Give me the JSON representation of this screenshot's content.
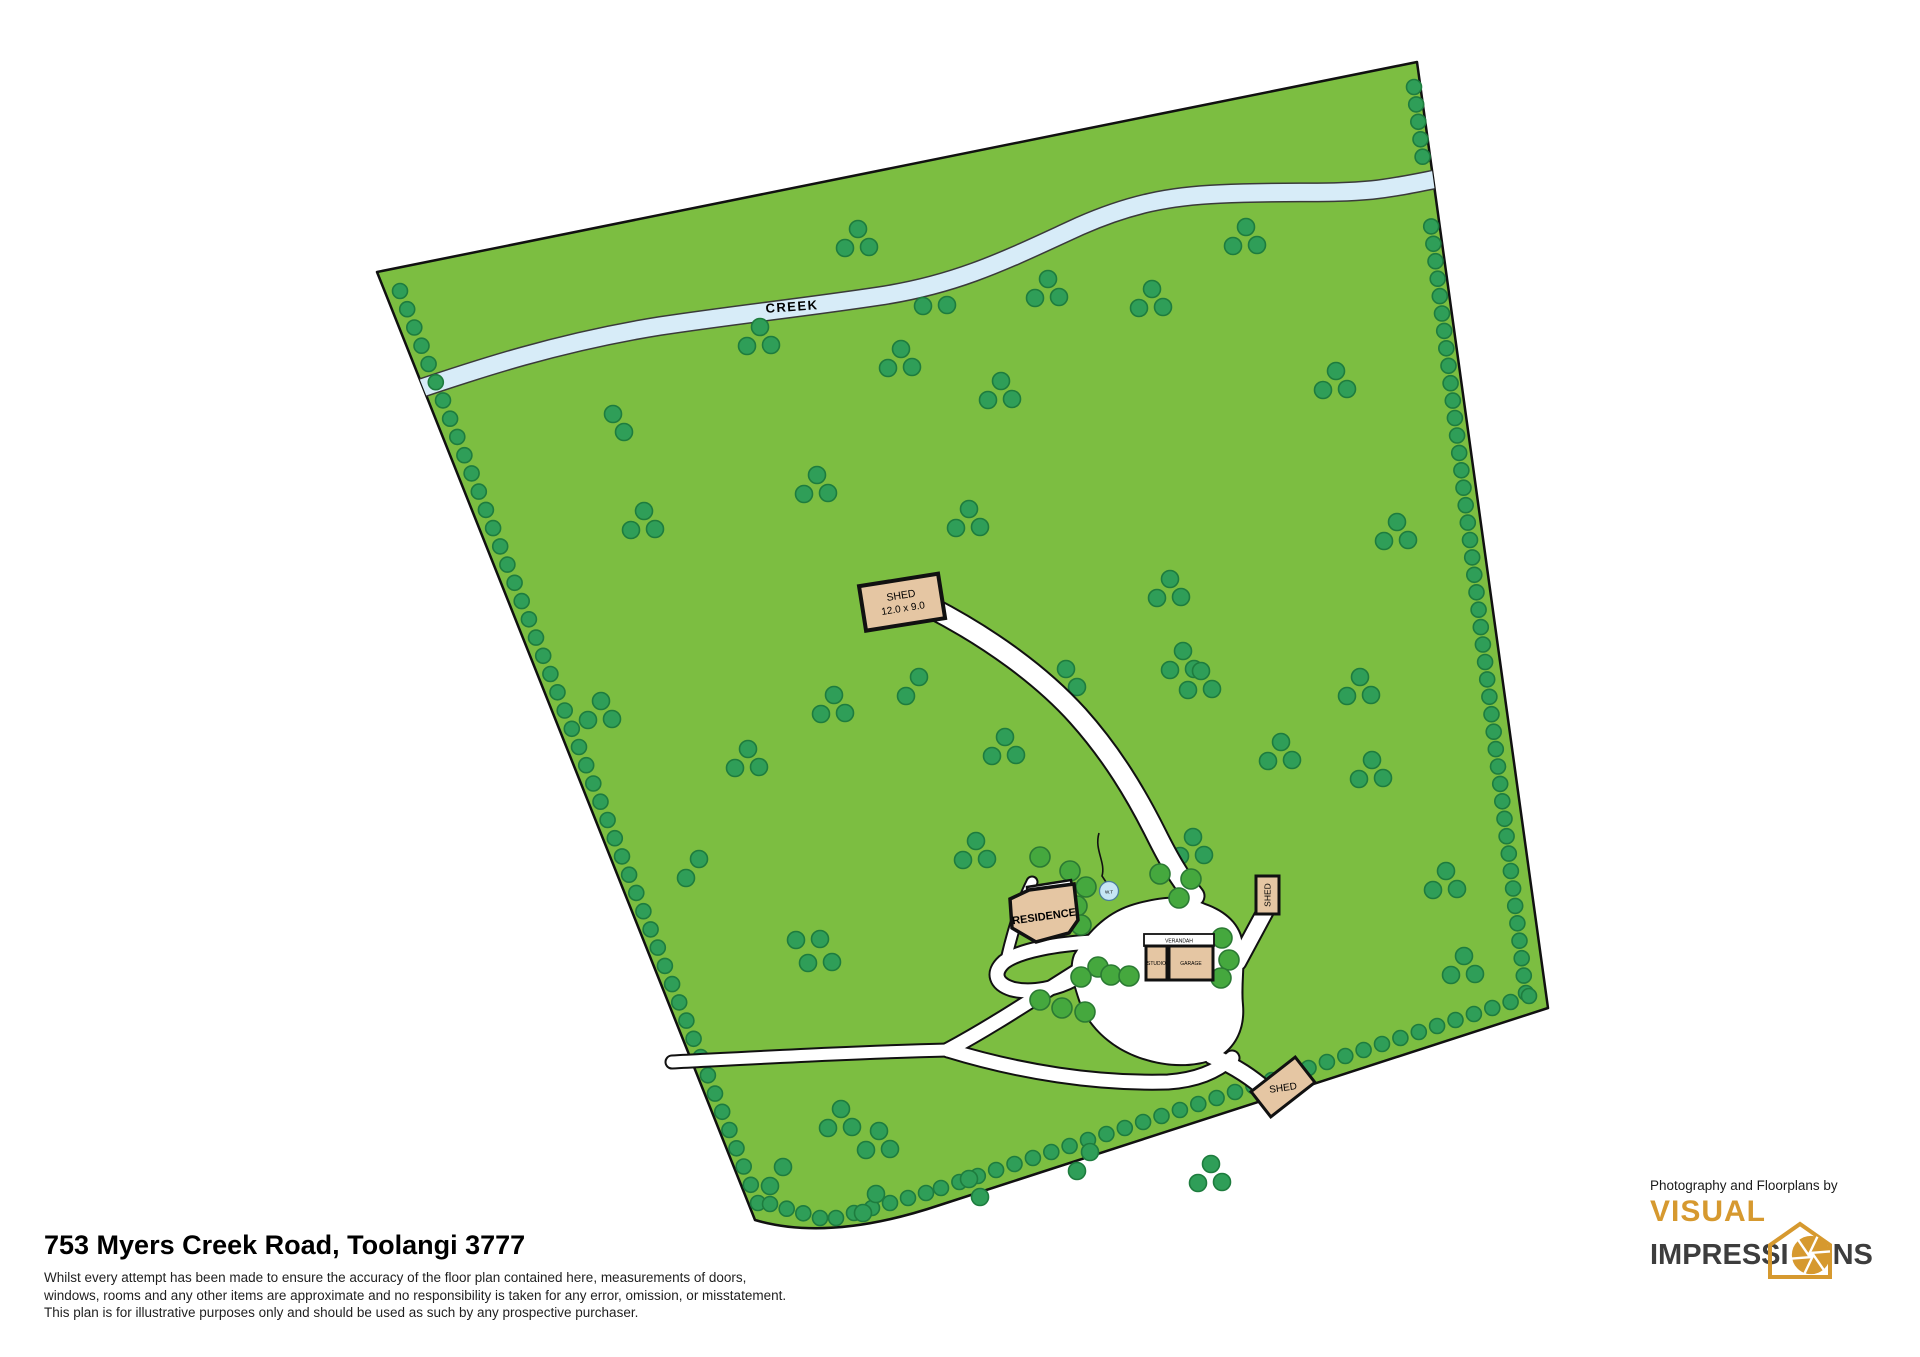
{
  "map": {
    "creek_label": "CREEK",
    "labels": {
      "big_shed_name": "SHED",
      "big_shed_size": "12.0 x 9.0",
      "residence": "RESIDENCE",
      "deck": "DECK",
      "verandah": "VERANDAH",
      "studio": "STUDIO",
      "garage": "GARAGE",
      "shed_east": "SHED",
      "shed_south": "SHED",
      "water_tank": "W.T"
    },
    "colors": {
      "ground": "#7CBE41",
      "boundary": "#111111",
      "paddock_tree": "#2F9E58",
      "paddock_tree_stroke": "#1E7C3E",
      "garden_tree": "#45A83E",
      "garden_tree_stroke": "#2B7A33",
      "creek_fill": "#D7ECF8",
      "creek_stroke": "#3A3A3A",
      "driveway_fill": "#FFFFFF",
      "driveway_stroke": "#111111",
      "building_fill": "#E5C6A3",
      "building_stroke": "#111111",
      "water_tank_fill": "#C6E6F5",
      "water_tank_stroke": "#4A7E9B"
    }
  },
  "footer": {
    "title": "753 Myers Creek Road, Toolangi 3777",
    "disclaimer_lines": [
      "Whilst every attempt has been made to ensure the accuracy of the floor plan contained here, measurements of doors,",
      "windows, rooms and any other items are approximate and no responsibility is taken for any error, omission, or misstatement.",
      "This plan is for illustrative purposes only and should be used as such by any prospective purchaser."
    ]
  },
  "credit": {
    "prefix": "Photography and Floorplans by",
    "brand_top": "VISUAL",
    "brand_bottom_pre": "IMPRESSI",
    "brand_bottom_post": "NS",
    "brand_gold": "#D6992F",
    "brand_dark": "#3D3D3D"
  }
}
